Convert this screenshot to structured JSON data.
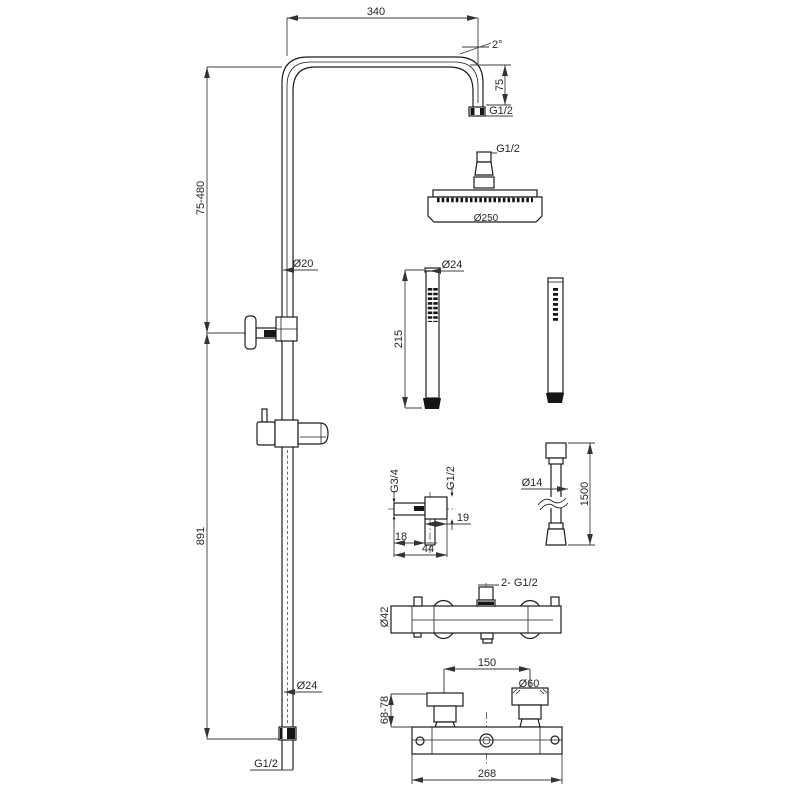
{
  "drawing": {
    "shower_arm": {
      "length": "340",
      "tilt_angle": "2°",
      "drop_height": "75",
      "outlet_thread": "G1/2"
    },
    "overhead_shower": {
      "connection_thread": "G1/2",
      "head_diameter": "Ø250"
    },
    "riser": {
      "upper_adjustment": "75-480",
      "pipe_diameter": "Ø20",
      "lower_length": "891",
      "bottom_pipe_diameter": "Ø24",
      "bottom_thread": "G1/2"
    },
    "hand_shower": {
      "diameter": "Ø24",
      "length": "215"
    },
    "hose": {
      "diameter": "Ø14",
      "length": "1500"
    },
    "wall_elbow": {
      "inlet_thread": "G3/4",
      "outlet_thread": "G1/2",
      "outlet_length": "19",
      "wall_offset": "18",
      "overall_width": "44"
    },
    "mixer_valve": {
      "connections": "2- G1/2",
      "body_diameter": "Ø42",
      "port_spacing": "150",
      "escutcheon_diameter": "Ø60",
      "depth_adjustment": "68-78",
      "overall_width": "268"
    }
  }
}
